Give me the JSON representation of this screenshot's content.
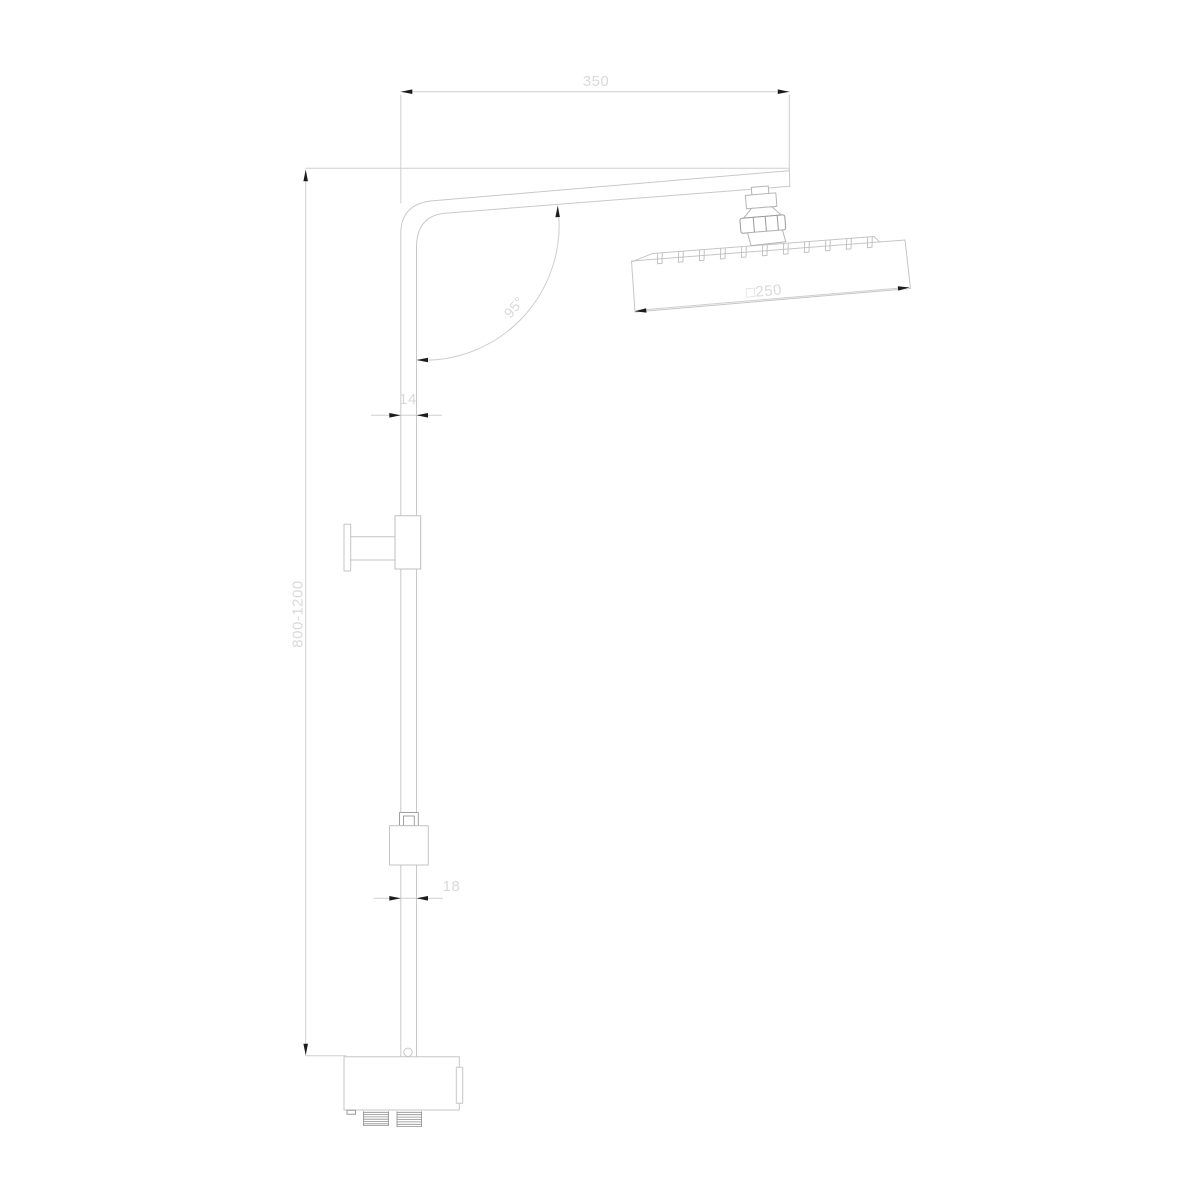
{
  "page": {
    "width": 1200,
    "height": 1200,
    "background": "#ffffff"
  },
  "drawing": {
    "kind": "technical line drawing",
    "subject": "Shower column with angled arm and square rain shower head, dimensioned side view",
    "colors": {
      "outline": "#c9c9c9",
      "fitting_outline": "#9a9a9a",
      "thread_hatch": "#8f8f8f",
      "arrowhead": "#1c1c1c",
      "dimension_text": "#d9d9d9",
      "background": "#ffffff"
    },
    "dimensions": {
      "arm_length": {
        "label": "350",
        "meaning": "shower arm horizontal span"
      },
      "column_height": {
        "label": "800-1200",
        "meaning": "adjustable riser height"
      },
      "upper_pipe_width": {
        "label": "14",
        "meaning": "upper riser pipe width"
      },
      "lower_pipe_width": {
        "label": "18",
        "meaning": "lower riser pipe width"
      },
      "arm_angle": {
        "label": "95°",
        "meaning": "angle between riser and arm"
      },
      "head_size": {
        "label": "□250",
        "meaning": "square shower head 250 mm"
      }
    },
    "parts": [
      {
        "name": "shower-arm"
      },
      {
        "name": "riser-pipe"
      },
      {
        "name": "wall-bracket"
      },
      {
        "name": "slider-block"
      },
      {
        "name": "hose-coupling"
      },
      {
        "name": "head-connector-nut"
      },
      {
        "name": "rain-shower-head"
      },
      {
        "name": "spray-nozzles",
        "count": 11
      },
      {
        "name": "mixer-body"
      },
      {
        "name": "threaded-outlets",
        "count": 2
      }
    ]
  }
}
